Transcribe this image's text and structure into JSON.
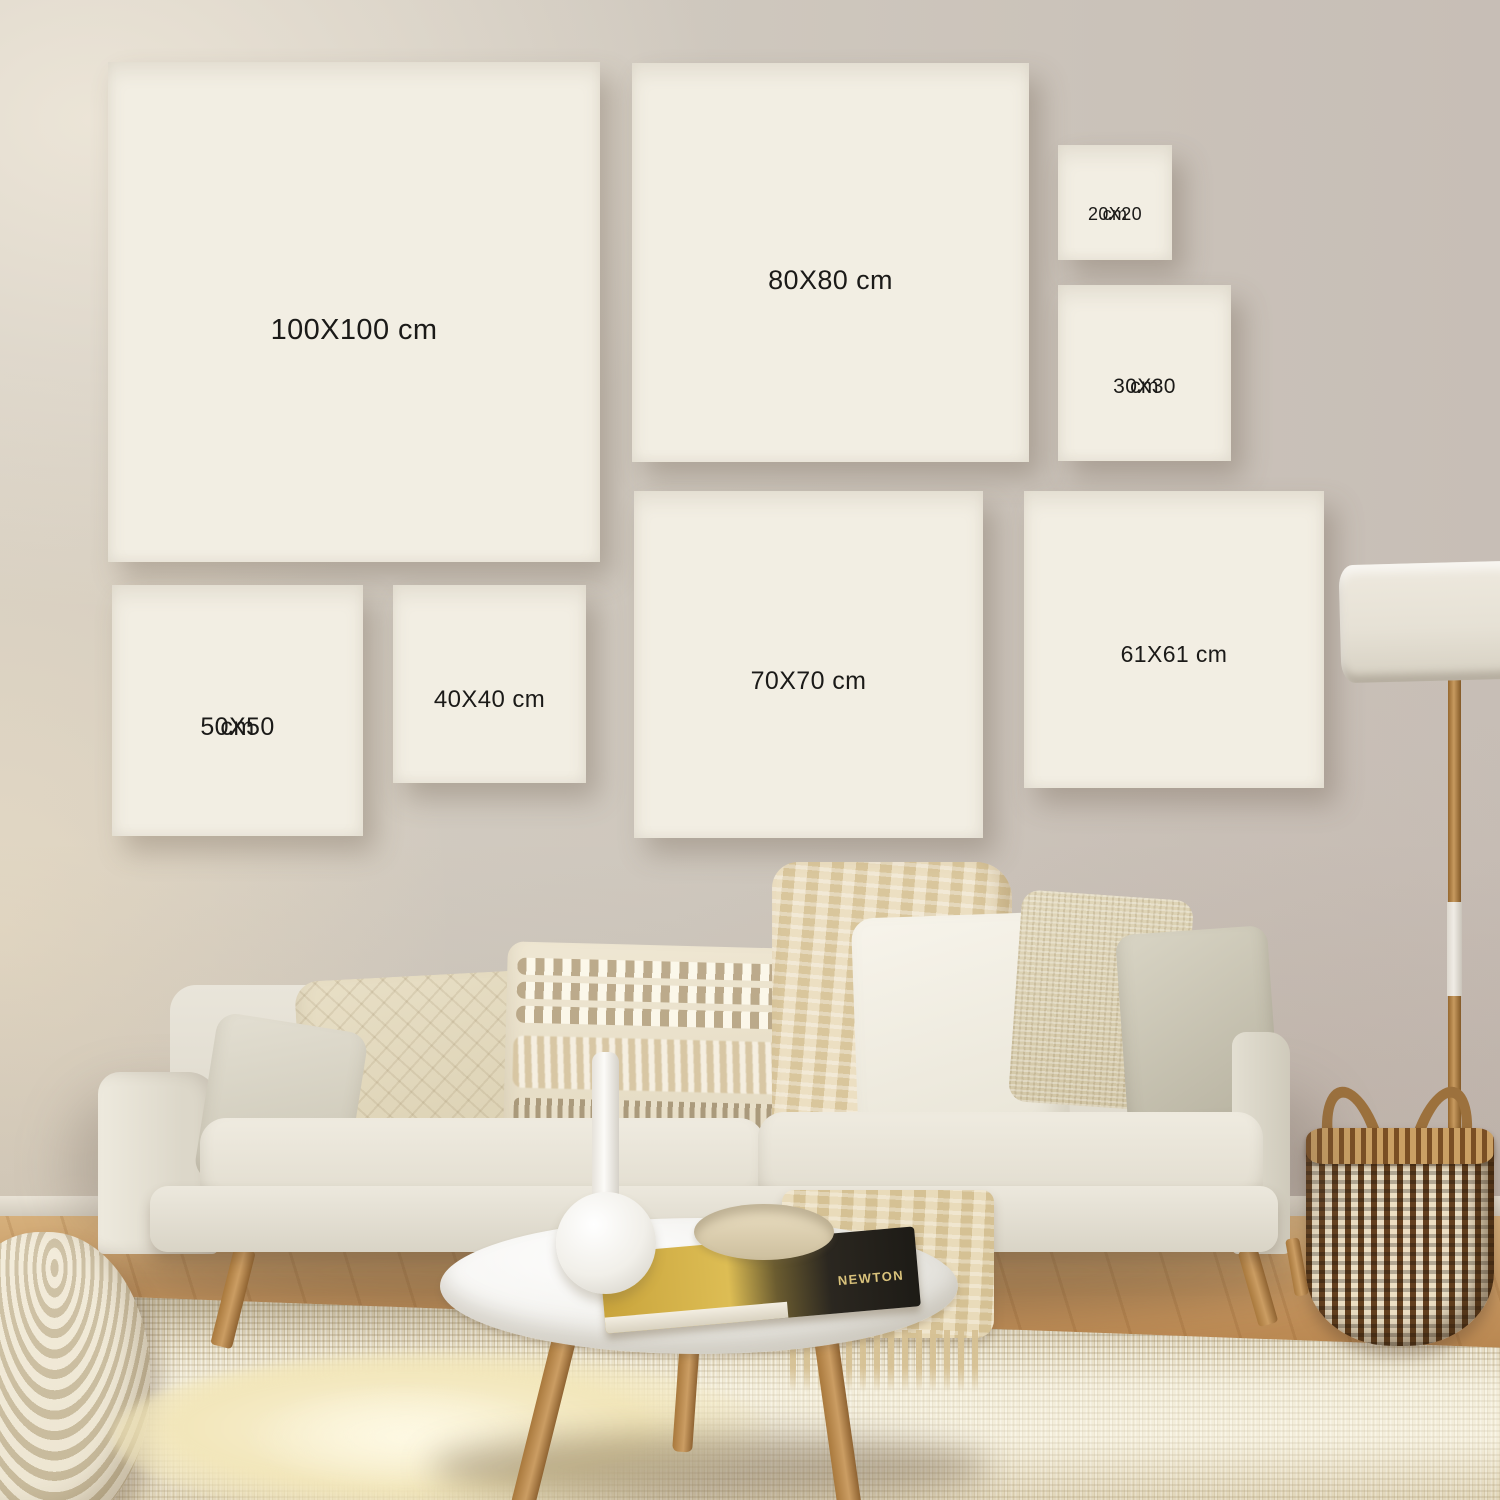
{
  "frames": [
    {
      "id": "100x100",
      "line1": "100X100 cm",
      "line2": null
    },
    {
      "id": "80x80",
      "line1": "80X80 cm",
      "line2": null
    },
    {
      "id": "20x20",
      "line1": "20X20",
      "line2": "cm"
    },
    {
      "id": "30x30",
      "line1": "30X30",
      "line2": "cm"
    },
    {
      "id": "50x50",
      "line1": "50X50",
      "line2": "cm"
    },
    {
      "id": "40x40",
      "line1": "40X40 cm",
      "line2": null
    },
    {
      "id": "70x70",
      "line1": "70X70 cm",
      "line2": null
    },
    {
      "id": "61x61",
      "line1": "61X61 cm",
      "line2": null
    }
  ],
  "book": {
    "spine_title": "NEWTON"
  },
  "palette": {
    "frame_border": "#0e0d0c",
    "frame_matte": "#f2eee3",
    "wall": "#cfc8be",
    "wood_floor": "#c1905a",
    "rug": "#e6dcc2",
    "sofa": "#e9e5da",
    "blanket": "#d9c69c",
    "basket_brown": "#63401f",
    "basket_cream": "#ecdfc4",
    "lamp_shade": "#e6e1d5",
    "label_text": "#1b1a18"
  }
}
